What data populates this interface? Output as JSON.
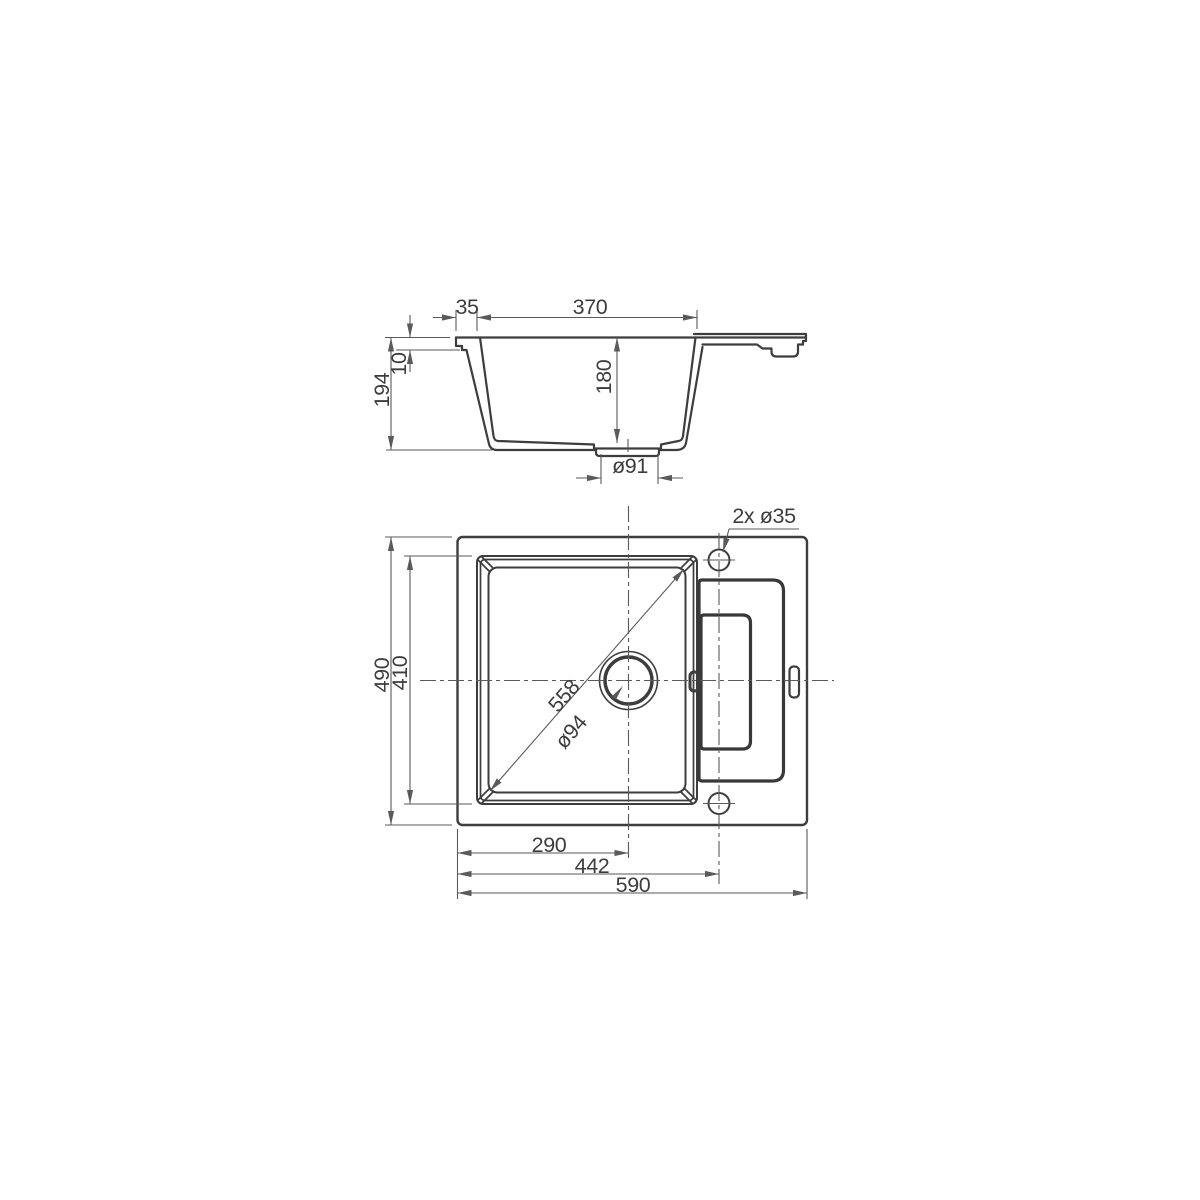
{
  "drawing": {
    "type": "technical-dimension-drawing",
    "subject": "single-bowl sink with drainer, section and plan views",
    "colors": {
      "background": "#ffffff",
      "profile": "#3d3d3d",
      "thick_outline": "#383838",
      "dimension": "#5a5a5a",
      "text": "#3d3d3d"
    },
    "section_view": {
      "offset_left": "35",
      "bowl_width": "370",
      "rim_depth": "10",
      "total_depth": "194",
      "bowl_depth": "180",
      "drain_recess_diameter": "ø91"
    },
    "plan_view": {
      "tap_holes": "2x ø35",
      "overall_depth": "490",
      "bowl_outer_depth": "410",
      "bowl_diagonal": "558",
      "drain_diameter": "ø94",
      "drain_center_from_left": "290",
      "tap_center_from_left": "442",
      "overall_width": "590"
    }
  }
}
